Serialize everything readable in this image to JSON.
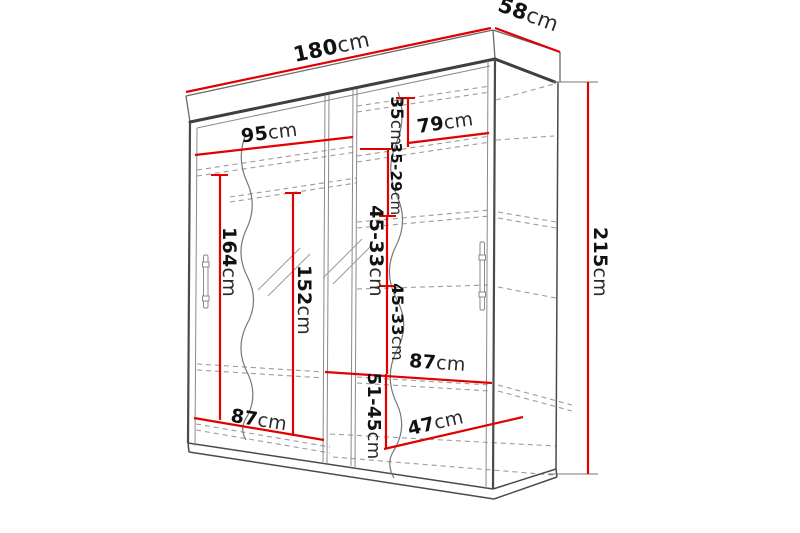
{
  "diagram": {
    "type": "furniture-dimension-drawing",
    "subject": "sliding-door mirrored wardrobe with interior shelves",
    "unit": "cm",
    "colors": {
      "dimension_line": "#e30000",
      "outline": "#3f3f3f",
      "dashed_shelf": "#9b9b9b",
      "text": "#111111",
      "background": "#ffffff"
    },
    "dims": {
      "overall_width": {
        "value": "180",
        "unit": "cm"
      },
      "overall_depth": {
        "value": "58",
        "unit": "cm"
      },
      "overall_height": {
        "value": "215",
        "unit": "cm"
      },
      "left_door_width": {
        "value": "95",
        "unit": "cm"
      },
      "right_section_width": {
        "value": "79",
        "unit": "cm"
      },
      "top_gap": {
        "value": "35",
        "unit": "cm"
      },
      "gap_2": {
        "value": "35-29",
        "unit": "cm"
      },
      "gap_3": {
        "value": "45-33",
        "unit": "cm"
      },
      "gap_4": {
        "value": "45-33",
        "unit": "cm"
      },
      "gap_5": {
        "value": "51-45",
        "unit": "cm"
      },
      "mirror_height": {
        "value": "164",
        "unit": "cm"
      },
      "interior_height": {
        "value": "152",
        "unit": "cm"
      },
      "bottom_left_width": {
        "value": "87",
        "unit": "cm"
      },
      "right_shelf_width": {
        "value": "87",
        "unit": "cm"
      },
      "interior_depth": {
        "value": "47",
        "unit": "cm"
      }
    }
  }
}
